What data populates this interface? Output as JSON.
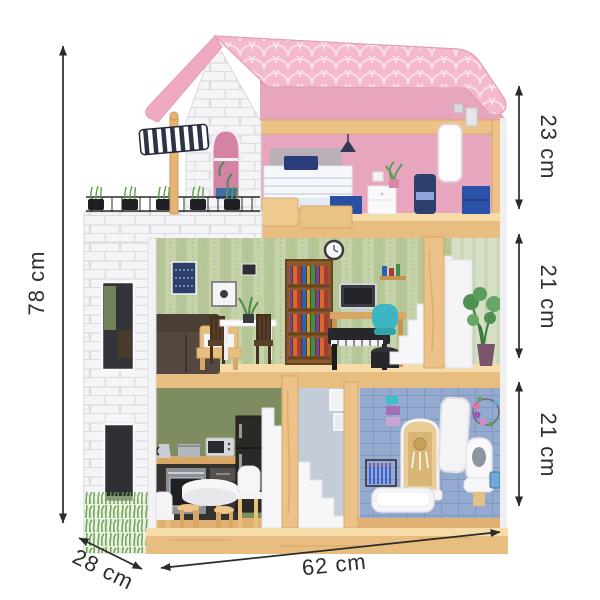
{
  "scene": {
    "product": "wooden dollhouse",
    "rooms": [
      {
        "name": "bedroom"
      },
      {
        "name": "living-room"
      },
      {
        "name": "kitchen"
      },
      {
        "name": "bathroom"
      }
    ]
  },
  "dimensions": {
    "total_height": {
      "label": "78 cm"
    },
    "floors": [
      {
        "name": "top-floor",
        "label": "23 cm"
      },
      {
        "name": "middle-floor",
        "label": "21 cm"
      },
      {
        "name": "ground-floor",
        "label": "21 cm"
      }
    ],
    "width": {
      "label": "62 cm"
    },
    "depth": {
      "label": "28 cm"
    }
  },
  "colors": {
    "background": "#FFFFFF",
    "annotation": "#2B2B2B",
    "roof_pink": "#F5B9CC",
    "bedroom_wall_pink": "#E8A6BE",
    "brick_white": "#F5F5F7",
    "wallpaper_green": "#C6D3AA",
    "kitchen_wall_olive": "#7D8D60",
    "bathroom_tile_blue": "#94ABCF",
    "wood_tan": "#EBBE7B",
    "stairs_white": "#F7F7F9",
    "awning_stripe": "#2E3347"
  }
}
